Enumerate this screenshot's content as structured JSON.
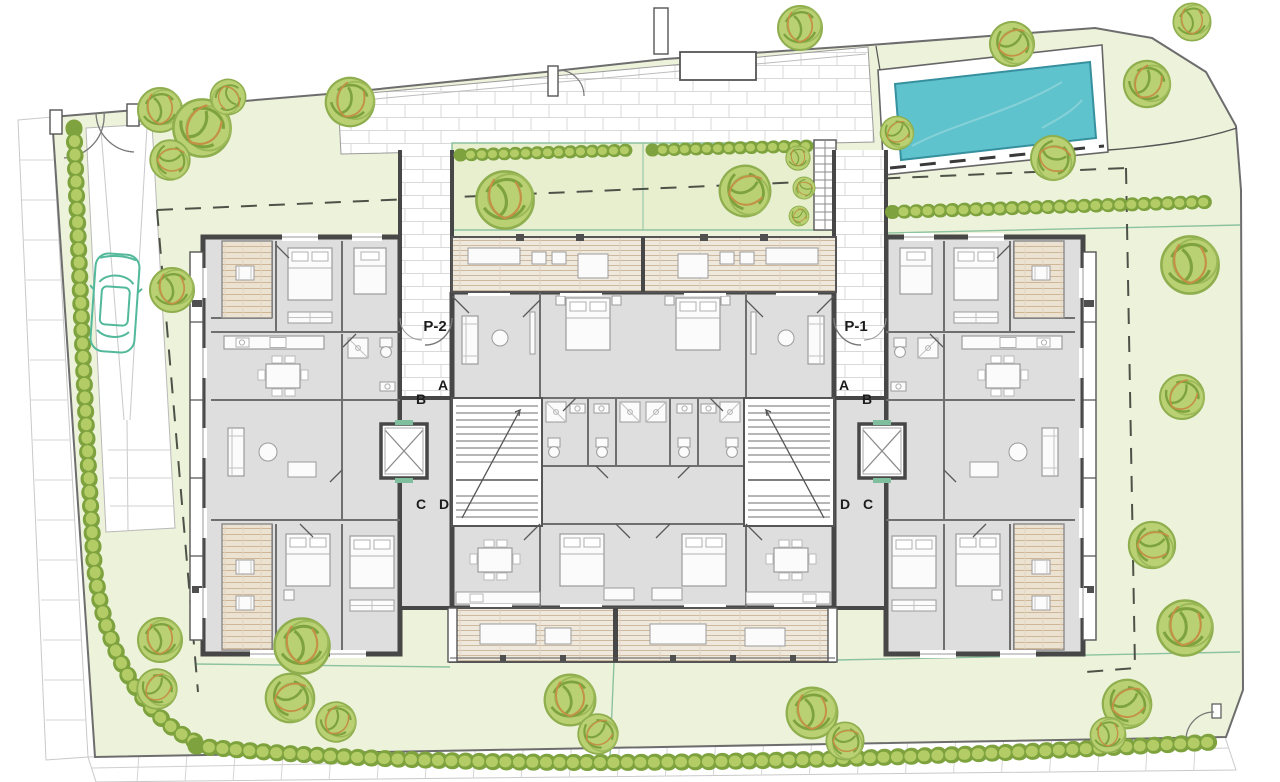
{
  "plan": {
    "type": "residential-site-and-floor-plan",
    "labels": {
      "stair_core_left": "P-2",
      "stair_core_right": "P-1",
      "unit_a": "A",
      "unit_b": "B",
      "unit_c": "C",
      "unit_d": "D"
    },
    "colors": {
      "lawn": "#edf2da",
      "garden_strip": "#e7efcf",
      "pool_water": "#5ec3cd",
      "pool_edge": "#37909e",
      "tree_foliage": "#b9d173",
      "tree_hatch": "#7da23e",
      "tree_accent": "#c49045",
      "building_wall": "#474747",
      "apartment_floor": "#dedede",
      "terrace_deck": "#efe9dd",
      "paving_joint": "#d9d9d9",
      "car_outline": "#53b99b",
      "setback_dash": "#4d5248",
      "garden_edge": "#8cc2a0"
    },
    "objects": [
      "swimming-pool",
      "pool-deck",
      "garden-strips",
      "hedge-rows",
      "trees",
      "parked-car",
      "driveway",
      "entrance-gates",
      "paved-plaza",
      "apartment-building",
      "stair-cores",
      "elevators",
      "balconies",
      "wood-deck-terraces",
      "setback-dashed-line",
      "sidewalks"
    ],
    "trees": [
      [
        160,
        110,
        1.0,
        0
      ],
      [
        202,
        128,
        1.3,
        40
      ],
      [
        170,
        160,
        0.9,
        90
      ],
      [
        228,
        97,
        0.8,
        160
      ],
      [
        350,
        102,
        1.1,
        20
      ],
      [
        800,
        28,
        1.0,
        0
      ],
      [
        1012,
        44,
        1.0,
        70
      ],
      [
        1147,
        84,
        1.05,
        30
      ],
      [
        1192,
        22,
        0.85,
        0
      ],
      [
        1053,
        158,
        1.0,
        110
      ],
      [
        897,
        133,
        0.75,
        60
      ],
      [
        505,
        200,
        1.3,
        0
      ],
      [
        745,
        191,
        1.15,
        80
      ],
      [
        798,
        158,
        0.55,
        0
      ],
      [
        804,
        188,
        0.5,
        120
      ],
      [
        799,
        216,
        0.45,
        60
      ],
      [
        1190,
        265,
        1.3,
        0
      ],
      [
        1182,
        397,
        1.0,
        45
      ],
      [
        1152,
        545,
        1.05,
        90
      ],
      [
        1185,
        628,
        1.25,
        10
      ],
      [
        1127,
        704,
        1.1,
        70
      ],
      [
        172,
        290,
        1.0,
        0
      ],
      [
        160,
        640,
        1.0,
        0
      ],
      [
        157,
        689,
        0.9,
        50
      ],
      [
        302,
        646,
        1.25,
        0
      ],
      [
        290,
        698,
        1.1,
        80
      ],
      [
        336,
        722,
        0.9,
        30
      ],
      [
        570,
        700,
        1.15,
        0
      ],
      [
        598,
        734,
        0.9,
        60
      ],
      [
        812,
        713,
        1.15,
        0
      ],
      [
        845,
        741,
        0.85,
        90
      ],
      [
        1108,
        735,
        0.8,
        0
      ]
    ]
  }
}
